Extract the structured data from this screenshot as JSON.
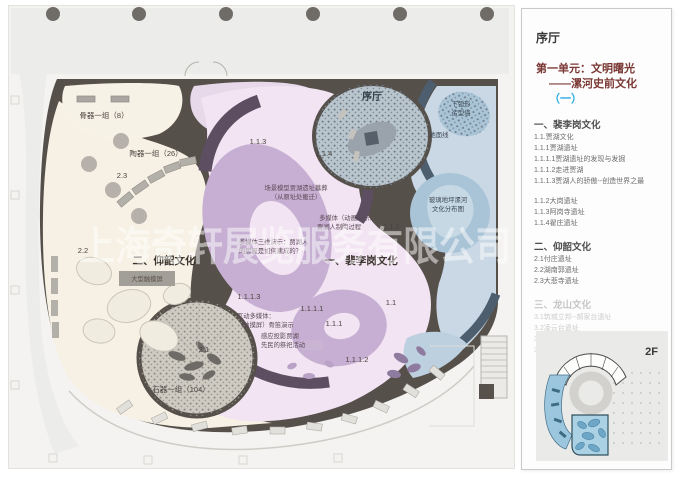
{
  "watermark": "上海奇轩展览服务有限公司",
  "colors": {
    "accent_blue": "#29abe2",
    "wall_dark": "#56504b",
    "cream_zone": "#f6f1e4",
    "pink_zone": "#f2e4f2",
    "lavender": "#c6afd2",
    "deep_purple": "#5e4e62",
    "blue_zone": "#c9d8e4",
    "blue_blob": "#a9c4d7",
    "navy_wall": "#4d5e6f",
    "speckle_base": "#b9c5cd",
    "stone_base": "#cdcac2",
    "minimap_highlight": "#9cc6dd"
  },
  "plan": {
    "labels": {
      "bone_group": "骨器一组（8）",
      "pottery_group": "陶器一组（26）",
      "stone_group": "石器一组（104）",
      "zone_2_3": "2.3",
      "zone_2_2": "2.2",
      "zone_2_1": "2.1",
      "unit2_title": "二、仰韶文化",
      "touchscreen": "大型触摸屏",
      "unit1_title": "一、裴李岗文化",
      "lobby": "序厅",
      "arc_wall_line1": "下弧形",
      "arc_wall_line2": "造型墙",
      "ground_line": "地面线",
      "glass_floor_line1": "玻璃地坪漯河",
      "glass_floor_line2": "文化分布图",
      "scene_model_line1": "场景模型贾湖遗址墓葬",
      "scene_model_line2": "（从原址处搬迁）",
      "anim_line1": "多媒体（动画演示）：",
      "anim_line2": "贾湖人制陶过程",
      "demo3d_line1": "多媒体三维演示：贾湖人",
      "demo3d_line2": "的房屋是如何建成的？",
      "interactive_line1": "互动多媒体：",
      "interactive_line2": "（触摸屏）骨笛演示",
      "projection_line1": "感应投影贾湖",
      "projection_line2": "先民的祭祀活动",
      "code_1_1": "1.1",
      "code_1_1_2": "1.1.2",
      "code_1_1_3": "1.1.3",
      "code_1_1_4": "1.1.4",
      "code_1_1_1": "1.1.1",
      "code_1_1_1_1": "1.1.1.1",
      "code_1_1_1_2": "1.1.1.2",
      "code_1_1_1_3": "1.1.1.3"
    }
  },
  "panel": {
    "lobby": "序厅",
    "unit_title": "第一单元：文明曙光",
    "unit_subtitle": "——漯河史前文化",
    "unit_suffix": "（一）",
    "floor_label": "2F",
    "sections": [
      {
        "heading": "一、裴李岗文化",
        "muted": false,
        "items": [
          "1.1.贾湖文化",
          "1.1.1贾湖遗址",
          "1.1.1.1贾湖遗址的发现与发掘",
          "1.1.1.2走进贾湖",
          "1.1.1.3贾湖人的骄傲--创造世界之最",
          "1.1.2大岗遗址",
          "1.1.3阿岗寺遗址",
          "1.1.4翟庄遗址"
        ]
      },
      {
        "heading": "二、仰韶文化",
        "muted": false,
        "items": [
          "2.1付庄遗址",
          "2.2湖南郭遗址",
          "2.3大悲寺遗址"
        ]
      },
      {
        "heading": "三、龙山文化",
        "muted": true,
        "items": [
          "3.1筑城立邦--郝家台遗址",
          "3.2凌云台遗址",
          "3.3华严寺遗址",
          "3.4漯河市其它龙山文化遗址"
        ]
      }
    ]
  }
}
